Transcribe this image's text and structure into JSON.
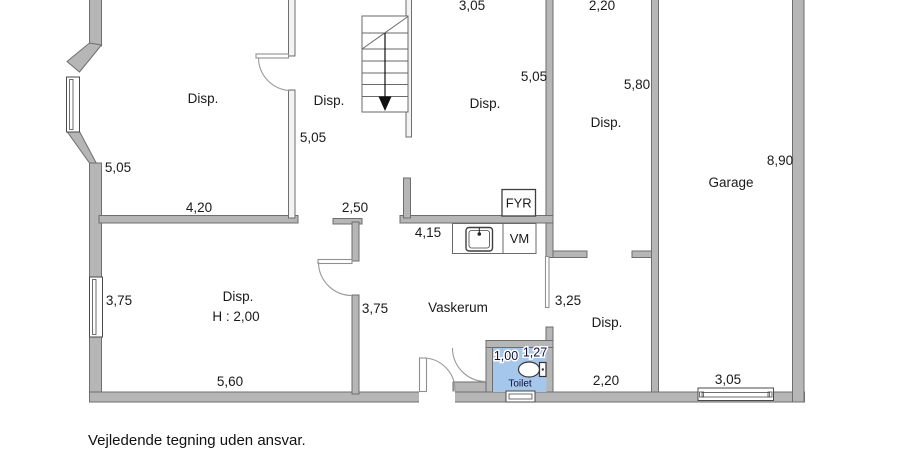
{
  "colors": {
    "wall": "#b6b6b6",
    "wall_edge": "#6e6e6e",
    "toilet_fill": "#a5c7ec",
    "text": "#1a1a1a",
    "toilet_text": "#101035"
  },
  "plan": {
    "rooms": {
      "upper_left": "Disp.",
      "stair_hall": "Disp.",
      "upper_mid": "Disp.",
      "upper_right": "Disp.",
      "garage": "Garage",
      "lower_left": "Disp.",
      "lower_left_ceiling": "H : 2,00",
      "laundry": "Vaskerum",
      "lower_right": "Disp.",
      "toilet": "Toilet"
    },
    "fixtures": {
      "boiler": "FYR",
      "washer": "VM"
    },
    "dims": {
      "top_mid": "3,05",
      "top_right": "2,20",
      "upper_left_height": "5,05",
      "upper_left_width": "4,20",
      "stair_hall_height": "5,05",
      "hall_width": "2,50",
      "mid_height": "5,05",
      "right_height": "5,80",
      "garage_height": "8,90",
      "laundry_width": "4,15",
      "lower_left_height": "3,75",
      "lower_left_width": "5,60",
      "laundry_height": "3,75",
      "lower_right_height": "3,25",
      "lower_right_width": "2,20",
      "garage_width": "3,05",
      "toilet_a": "1,00",
      "toilet_b": "1,27"
    }
  },
  "footer": {
    "disclaimer": "Vejledende tegning uden ansvar."
  }
}
